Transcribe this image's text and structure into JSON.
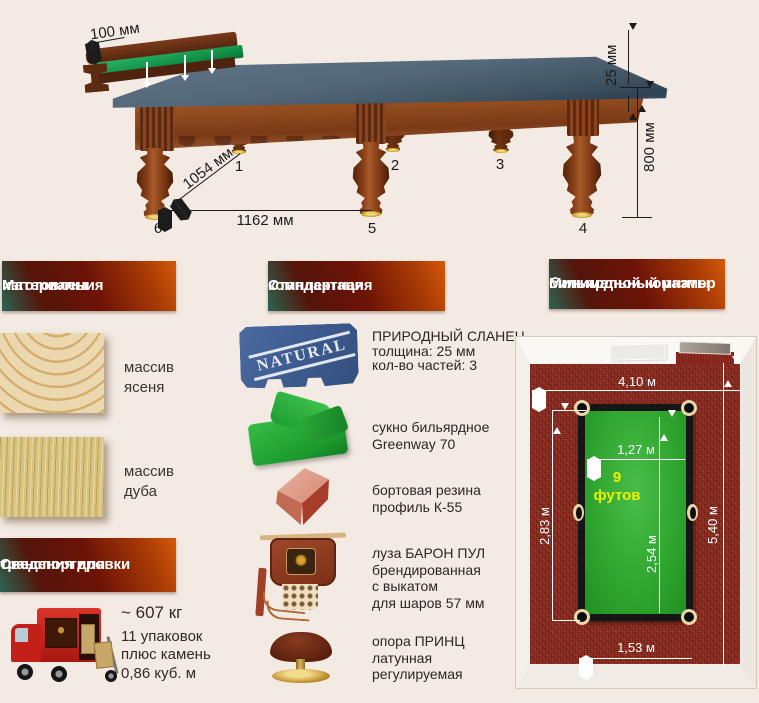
{
  "table_figure": {
    "rail_width": "100 мм",
    "slate_thickness": "25 мм",
    "table_height": "800 мм",
    "leg_diagonal": "1054 мм",
    "leg_spacing": "1162 мм",
    "legs": [
      "1",
      "2",
      "3",
      "4",
      "5",
      "6"
    ]
  },
  "headers": {
    "materials": [
      "Материалы",
      "изготовления"
    ],
    "equipment": [
      "Стандартная",
      "комплектация"
    ],
    "room": [
      "Минимальный размер",
      "бильярдной комнаты"
    ],
    "transport": [
      "Сведения для",
      "транспортировки"
    ]
  },
  "materials": [
    {
      "line1": "массив",
      "line2": "ясеня"
    },
    {
      "line1": "массив",
      "line2": "дуба"
    }
  ],
  "transport": {
    "weight": "~ 607 кг",
    "packages1": "11 упаковок",
    "packages2": "плюс камень",
    "volume": "0,86 куб. м"
  },
  "equipment": [
    {
      "stamp": "NATURAL",
      "lines": [
        "ПРИРОДНЫЙ СЛАНЕЦ",
        "толщина: 25 мм",
        "кол-во частей: 3"
      ]
    },
    {
      "lines": [
        "сукно бильярдное",
        "Greenway 70"
      ]
    },
    {
      "lines": [
        "бортовая резина",
        "профиль К-55"
      ]
    },
    {
      "lines": [
        "луза БАРОН ПУЛ",
        "брендированная",
        "с выкатом",
        "для шаров 57 мм"
      ]
    },
    {
      "lines": [
        "опора ПРИНЦ",
        "латунная",
        "регулируемая"
      ]
    }
  ],
  "room": {
    "width": "4,10 м",
    "length": "5,40 м",
    "side_clearance": "2,83 м",
    "table_width": "1,27 м",
    "table_length": "2,54 м",
    "end_clearance": "1,53 м",
    "table_size_line1": "9",
    "table_size_line2": "футов"
  },
  "colors": {
    "background": "#f3eae3",
    "header_orange": "#d4590a",
    "header_maroon": "#6d1306",
    "carpet_red": "#8e2b20",
    "felt_green": "#2ea52e",
    "slate_blue": "#3d5a8e",
    "size_yellow": "#eef000"
  }
}
